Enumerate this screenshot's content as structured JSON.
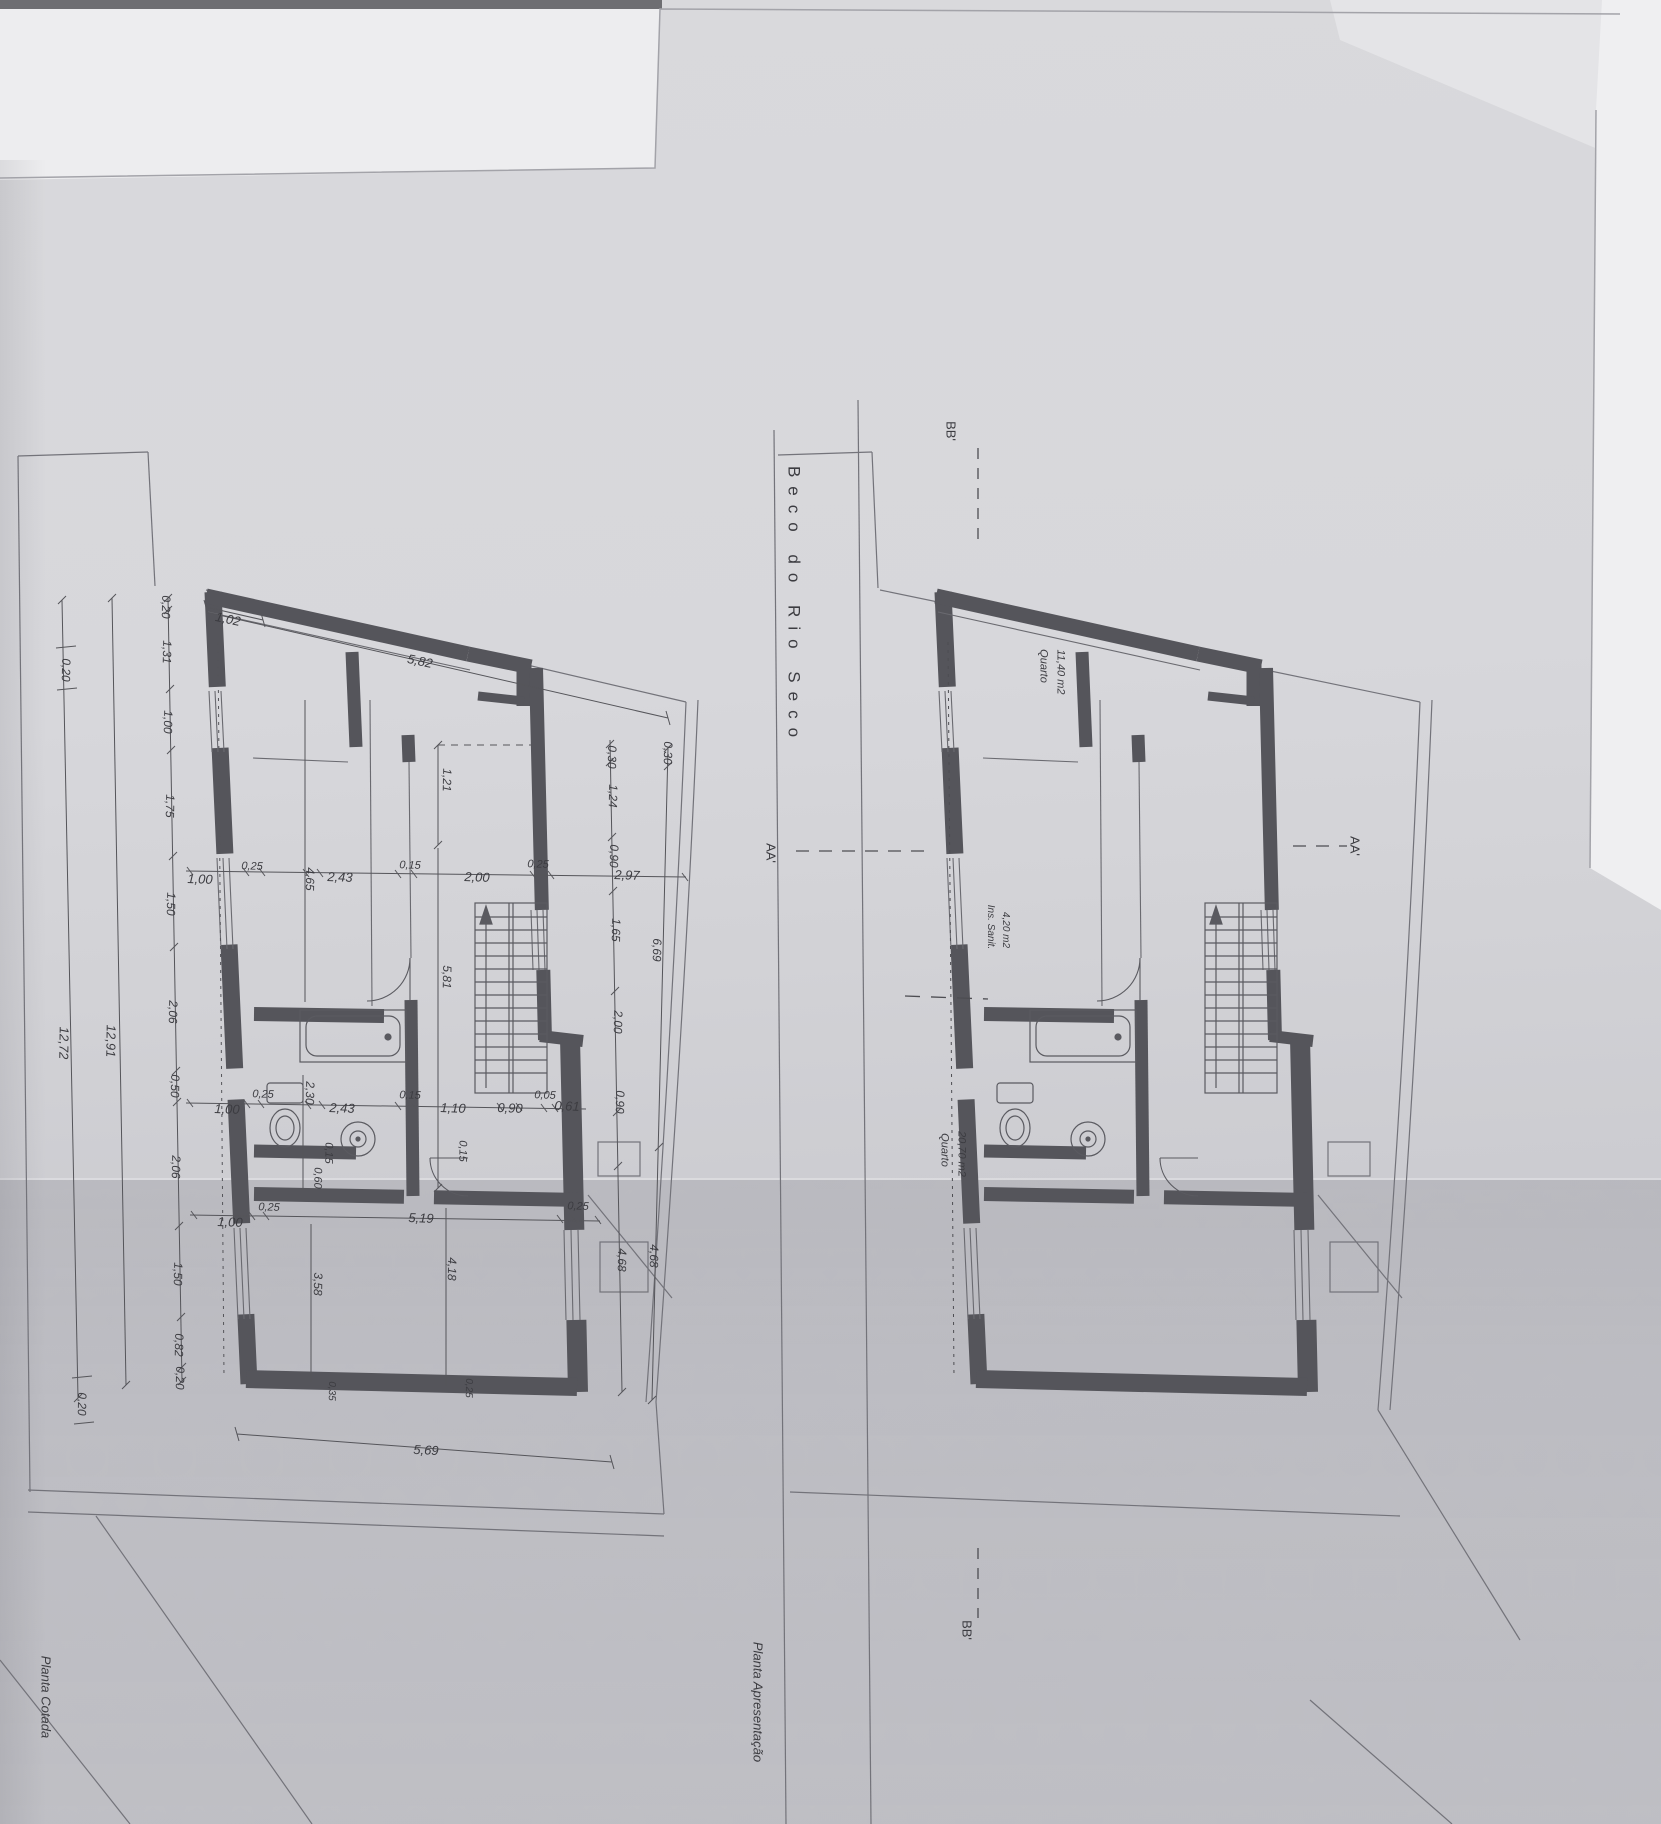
{
  "document": {
    "street_name": "Beco do Rio Seco",
    "left_plan_title": "Planta Cotada",
    "right_plan_title": "Planta Apresentação"
  },
  "colors": {
    "paper": "#d4d4d8",
    "wall": "#55555b",
    "thin_line": "#6a6a70",
    "text": "#3c3c41"
  },
  "rooms": [
    {
      "name": "Quarto",
      "area": "11,40 m2"
    },
    {
      "name": "Ins. Sanit.",
      "area": "4,20 m2"
    },
    {
      "name": "Quarto",
      "area": "20,70 m2"
    }
  ],
  "section_marks": [
    "BB'",
    "AA'",
    "AA'",
    "BB'"
  ],
  "dimensions": {
    "top": [
      "1,02",
      "5,82"
    ],
    "left_outer": [
      "0,20",
      "12,72",
      "0,20"
    ],
    "left_total": "12,91",
    "left_chain": [
      "0,20",
      "1,31",
      "1,00",
      "1,75",
      "1,50",
      "2,06",
      "0,50",
      "2,06",
      "1,50",
      "0,82",
      "0,20"
    ],
    "right_chain_inner": [
      "0,30",
      "1,24",
      "0,90",
      "1,65",
      "2,00",
      "0,90",
      "4,68"
    ],
    "right_chain_outer": [
      "0,30",
      "6,69",
      "4,68"
    ],
    "row_upper": [
      "1,00",
      "0,25",
      "4,65",
      "2,43",
      "0,15",
      "2,00",
      "0,25",
      "2,97"
    ],
    "mid_vertical": [
      "1,21",
      "5,81"
    ],
    "row_middle": [
      "1,00",
      "0,25",
      "2,30",
      "2,43",
      "0,15",
      "1,10",
      "0,90",
      "0,05",
      "0,61"
    ],
    "small_marks": [
      "0,15",
      "0,15",
      "0,60",
      "0,35",
      "0,25"
    ],
    "row_lower": [
      "1,00",
      "0,25",
      "5,19",
      "0,25"
    ],
    "lower_vertical": [
      "3,58",
      "4,18"
    ],
    "bottom": "5,69"
  },
  "labels": [
    {
      "n": "dim-1-02",
      "t": "1,02",
      "x": 228,
      "y": 619,
      "r": 12
    },
    {
      "n": "dim-5-82",
      "t": "5,82",
      "x": 420,
      "y": 661,
      "r": 12
    },
    {
      "n": "chain-0-20a",
      "t": "0,20",
      "x": 166,
      "y": 607,
      "r": 91,
      "s": 12
    },
    {
      "n": "chain-1-31",
      "t": "1,31",
      "x": 167,
      "y": 652,
      "r": 91,
      "s": 12
    },
    {
      "n": "chain-1-00",
      "t": "1,00",
      "x": 168,
      "y": 722,
      "r": 91,
      "s": 12
    },
    {
      "n": "chain-1-75",
      "t": "1,75",
      "x": 170,
      "y": 806,
      "r": 91,
      "s": 12
    },
    {
      "n": "chain-1-50a",
      "t": "1,50",
      "x": 171,
      "y": 904,
      "r": 91,
      "s": 12
    },
    {
      "n": "chain-2-06a",
      "t": "2,06",
      "x": 173,
      "y": 1012,
      "r": 91,
      "s": 12
    },
    {
      "n": "chain-0-50",
      "t": "0,50",
      "x": 175,
      "y": 1086,
      "r": 91,
      "s": 12
    },
    {
      "n": "chain-2-06b",
      "t": "2,06",
      "x": 176,
      "y": 1167,
      "r": 91,
      "s": 12
    },
    {
      "n": "chain-1-50b",
      "t": "1,50",
      "x": 178,
      "y": 1274,
      "r": 91,
      "s": 12
    },
    {
      "n": "chain-0-82",
      "t": "0,82",
      "x": 179,
      "y": 1345,
      "r": 91,
      "s": 12
    },
    {
      "n": "chain-0-20b",
      "t": "0,20",
      "x": 180,
      "y": 1378,
      "r": 91,
      "s": 12
    },
    {
      "n": "dim-12-91",
      "t": "12,91",
      "x": 111,
      "y": 1041,
      "r": 91
    },
    {
      "n": "dim-12-72",
      "t": "12,72",
      "x": 64,
      "y": 1043,
      "r": 91
    },
    {
      "n": "dim-0-20-outer-top",
      "t": "0,20",
      "x": 66,
      "y": 670,
      "r": 91,
      "s": 12
    },
    {
      "n": "dim-0-20-outer-bottom",
      "t": "0,20",
      "x": 82,
      "y": 1404,
      "r": 91,
      "s": 12
    },
    {
      "n": "rchain-0-30",
      "t": "0,30",
      "x": 612,
      "y": 757,
      "r": 91,
      "s": 12
    },
    {
      "n": "rchain-1-24",
      "t": "1,24",
      "x": 613,
      "y": 796,
      "r": 91,
      "s": 12
    },
    {
      "n": "rchain-0-90a",
      "t": "0,90",
      "x": 614,
      "y": 856,
      "r": 91,
      "s": 12
    },
    {
      "n": "rchain-1-65",
      "t": "1,65",
      "x": 616,
      "y": 930,
      "r": 91,
      "s": 12
    },
    {
      "n": "rchain-2-00",
      "t": "2,00",
      "x": 618,
      "y": 1022,
      "r": 91,
      "s": 12
    },
    {
      "n": "rchain-0-90b",
      "t": "0,90",
      "x": 620,
      "y": 1102,
      "r": 91,
      "s": 12
    },
    {
      "n": "rchain-4-68a",
      "t": "4,68",
      "x": 622,
      "y": 1260,
      "r": 91,
      "s": 12
    },
    {
      "n": "rchain2-0-30",
      "t": "0,30",
      "x": 668,
      "y": 753,
      "r": 91,
      "s": 12
    },
    {
      "n": "rchain2-6-69",
      "t": "6,69",
      "x": 657,
      "y": 950,
      "r": 91,
      "s": 12
    },
    {
      "n": "rchain2-4-68b",
      "t": "4,68",
      "x": 654,
      "y": 1256,
      "r": 91,
      "s": 12
    },
    {
      "n": "row1-1-00",
      "t": "1,00",
      "x": 200,
      "y": 879,
      "r": 2
    },
    {
      "n": "row1-0-25a",
      "t": "0,25",
      "x": 252,
      "y": 867,
      "r": 2,
      "s": 11
    },
    {
      "n": "row1-4-65",
      "t": "4,65",
      "x": 310,
      "y": 879,
      "r": 91,
      "s": 12
    },
    {
      "n": "row1-2-43",
      "t": "2,43",
      "x": 340,
      "y": 877,
      "r": 2
    },
    {
      "n": "row1-0-15",
      "t": "0,15",
      "x": 410,
      "y": 866,
      "r": 2,
      "s": 11
    },
    {
      "n": "row1-2-00",
      "t": "2,00",
      "x": 477,
      "y": 877,
      "r": 2
    },
    {
      "n": "row1-0-25b",
      "t": "0,25",
      "x": 538,
      "y": 865,
      "r": 2,
      "s": 11
    },
    {
      "n": "row1-2-97",
      "t": "2,97",
      "x": 627,
      "y": 875,
      "r": 2
    },
    {
      "n": "dim-1-21",
      "t": "1,21",
      "x": 447,
      "y": 780,
      "r": 91,
      "s": 12
    },
    {
      "n": "dim-5-81",
      "t": "5,81",
      "x": 447,
      "y": 977,
      "r": 91,
      "s": 12
    },
    {
      "n": "row2-1-00",
      "t": "1,00",
      "x": 227,
      "y": 1109,
      "r": 2
    },
    {
      "n": "row2-0-25",
      "t": "0,25",
      "x": 263,
      "y": 1095,
      "r": 2,
      "s": 11
    },
    {
      "n": "dim-2-30",
      "t": "2,30",
      "x": 310,
      "y": 1093,
      "r": 91,
      "s": 12
    },
    {
      "n": "row2-2-43",
      "t": "2,43",
      "x": 342,
      "y": 1108,
      "r": 2
    },
    {
      "n": "row2-0-15",
      "t": "0,15",
      "x": 410,
      "y": 1096,
      "r": 2,
      "s": 11
    },
    {
      "n": "row2-1-10",
      "t": "1,10",
      "x": 453,
      "y": 1108,
      "r": 2
    },
    {
      "n": "row2-0-90",
      "t": "0,90",
      "x": 510,
      "y": 1108,
      "r": 2
    },
    {
      "n": "row2-0-05",
      "t": "0,05",
      "x": 545,
      "y": 1096,
      "r": 2,
      "s": 11
    },
    {
      "n": "row2-0-61",
      "t": "0,61",
      "x": 567,
      "y": 1106,
      "r": 2
    },
    {
      "n": "small-0-15a",
      "t": "0,15",
      "x": 462,
      "y": 1151,
      "r": 91,
      "s": 11
    },
    {
      "n": "small-0-15b",
      "t": "0,15",
      "x": 328,
      "y": 1153,
      "r": 91,
      "s": 11
    },
    {
      "n": "small-0-60",
      "t": "0,60",
      "x": 317,
      "y": 1178,
      "r": 91,
      "s": 11
    },
    {
      "n": "row3-1-00",
      "t": "1,00",
      "x": 230,
      "y": 1222,
      "r": 2
    },
    {
      "n": "row3-0-25a",
      "t": "0,25",
      "x": 269,
      "y": 1208,
      "r": 2,
      "s": 11
    },
    {
      "n": "row3-5-19",
      "t": "5,19",
      "x": 421,
      "y": 1218,
      "r": 2
    },
    {
      "n": "row3-0-25b",
      "t": "0,25",
      "x": 578,
      "y": 1207,
      "r": 2,
      "s": 11
    },
    {
      "n": "dim-3-58",
      "t": "3,58",
      "x": 318,
      "y": 1284,
      "r": 91,
      "s": 12
    },
    {
      "n": "dim-4-18",
      "t": "4,18",
      "x": 452,
      "y": 1269,
      "r": 91,
      "s": 12
    },
    {
      "n": "dim-5-69",
      "t": "5,69",
      "x": 426,
      "y": 1450,
      "r": 3
    },
    {
      "n": "mark-0-35",
      "t": "0,35",
      "x": 331,
      "y": 1391,
      "r": 91,
      "s": 10
    },
    {
      "n": "mark-0-25",
      "t": "0,25",
      "x": 468,
      "y": 1388,
      "r": 91,
      "s": 10
    },
    {
      "n": "left-plan-title",
      "t": "Planta Cotada",
      "x": 46,
      "y": 1697,
      "r": 90,
      "s": 13
    },
    {
      "n": "street-name",
      "t": "Beco do Rio Seco",
      "x": 794,
      "y": 606,
      "r": 90,
      "s": 17,
      "ls": 9,
      "u": 1
    },
    {
      "n": "section-bb-top",
      "t": "BB'",
      "x": 951,
      "y": 431,
      "r": 90,
      "u": 1
    },
    {
      "n": "section-bb-bottom",
      "t": "BB'",
      "x": 967,
      "y": 1630,
      "r": 90,
      "u": 1
    },
    {
      "n": "section-aa-left",
      "t": "AA'",
      "x": 771,
      "y": 853,
      "r": 90,
      "u": 1
    },
    {
      "n": "section-aa-right",
      "t": "AA'",
      "x": 1355,
      "y": 846,
      "r": 90,
      "u": 1
    },
    {
      "n": "room1-name",
      "t": "Quarto",
      "x": 1043,
      "y": 666,
      "r": 90,
      "s": 11
    },
    {
      "n": "room1-area",
      "t": "11,40 m2",
      "x": 1060,
      "y": 672,
      "r": 90,
      "s": 11
    },
    {
      "n": "room2-name",
      "t": "Ins. Sanit.",
      "x": 990,
      "y": 927,
      "r": 90,
      "s": 10
    },
    {
      "n": "room2-area",
      "t": "4,20 m2",
      "x": 1005,
      "y": 930,
      "r": 90,
      "s": 10
    },
    {
      "n": "room3-name",
      "t": "Quarto",
      "x": 944,
      "y": 1150,
      "r": 90,
      "s": 11
    },
    {
      "n": "room3-area",
      "t": "20,70 m2",
      "x": 961,
      "y": 1154,
      "r": 90,
      "s": 11
    },
    {
      "n": "right-plan-title",
      "t": "Planta Apresentação",
      "x": 758,
      "y": 1702,
      "r": 90,
      "s": 13
    }
  ]
}
